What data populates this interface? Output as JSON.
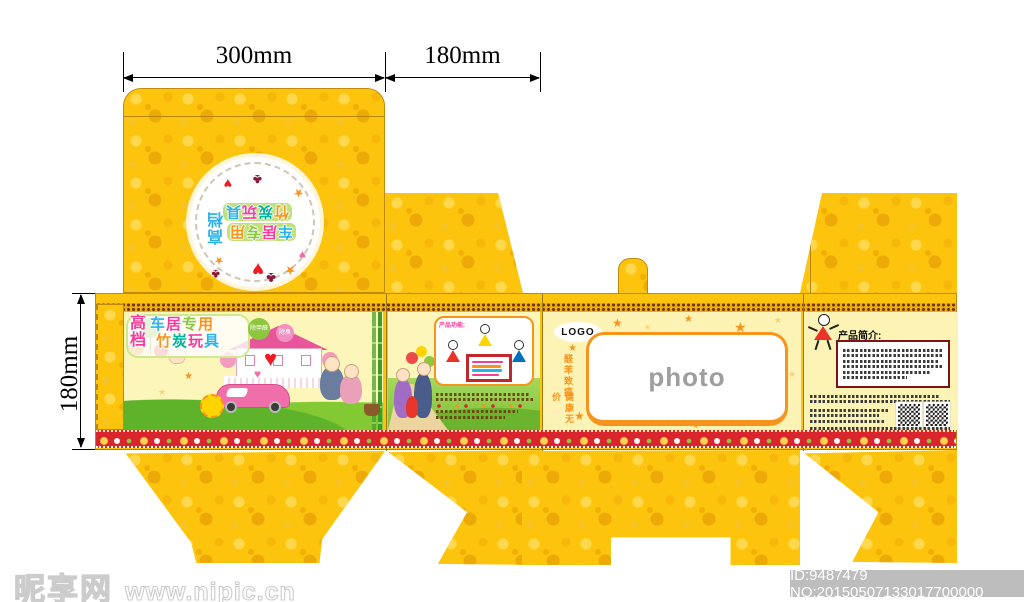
{
  "dimensions": {
    "width_top": "300mm",
    "depth_top": "180mm",
    "height_left": "180mm"
  },
  "lid": {
    "badge": {
      "grade": [
        "高",
        "档"
      ],
      "line1": [
        "车",
        "居",
        "专",
        "用"
      ],
      "line2": [
        "竹",
        "炭",
        "玩",
        "具"
      ]
    }
  },
  "front_panel": {
    "grade": [
      "高",
      "档"
    ],
    "title_line1": [
      "车",
      "居",
      "专",
      "用"
    ],
    "title_line2": [
      "竹",
      "炭",
      "玩",
      "具"
    ],
    "bubble1": "除甲醛",
    "bubble2": "除臭"
  },
  "features_panel": {
    "heading": "产品功能:"
  },
  "back_panel": {
    "logo": "LOGO",
    "slogan_vertical_1": "醛苯致癌",
    "slogan_vertical_2": "健康无价",
    "photo_placeholder": "photo"
  },
  "intro_panel": {
    "heading": "产品简介:"
  },
  "watermark": {
    "site_name": "昵享网",
    "site_url": "www.nipic.cn",
    "image_id": "ID:9487479 NO:20150507133017700000"
  },
  "icons": {
    "heart": "♥",
    "star": "★",
    "clover": "♣"
  },
  "colors": {
    "box_yellow": "#fcc40d",
    "pattern_orange": "#eca907",
    "panel_cream": "#fdf6bb",
    "accent_orange": "#f7941d",
    "sign_red": "#c1272d",
    "deco_red": "#d8262c",
    "title_pink": "#f23d9a",
    "title_blue": "#2bb3e8",
    "title_green": "#8dc63f"
  }
}
